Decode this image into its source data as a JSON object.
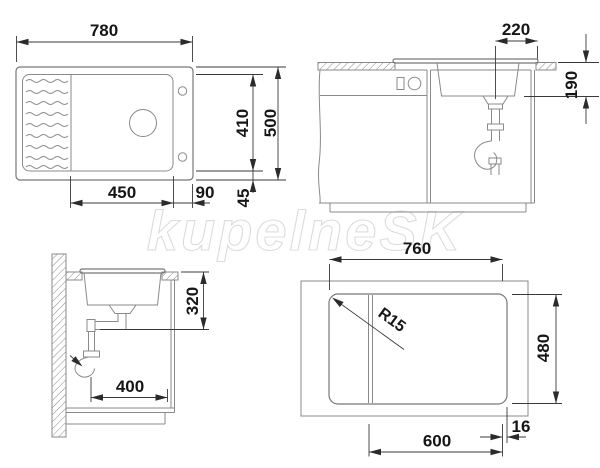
{
  "colors": {
    "background": "#ffffff",
    "drawing_line": "#8a8a8a",
    "dimension_line": "#3a3a3a",
    "dimension_text": "#161616",
    "watermark": "#dcdcdc"
  },
  "watermark": {
    "text": "kupelneSK"
  },
  "views": {
    "plan": {
      "dims": {
        "overall_width": "780",
        "overall_depth": "500",
        "bowl_depth": "410",
        "bowl_width": "450",
        "edge_right": "90",
        "edge_bottom": "45"
      }
    },
    "front": {
      "dims": {
        "drain_to_edge": "220",
        "bowl_depth": "190"
      }
    },
    "side": {
      "dims": {
        "drain_height": "320",
        "clearance": "400"
      }
    },
    "cutout": {
      "dims": {
        "width": "760",
        "depth": "480",
        "cabinet": "600",
        "offset": "16",
        "radius": "R15"
      }
    }
  }
}
